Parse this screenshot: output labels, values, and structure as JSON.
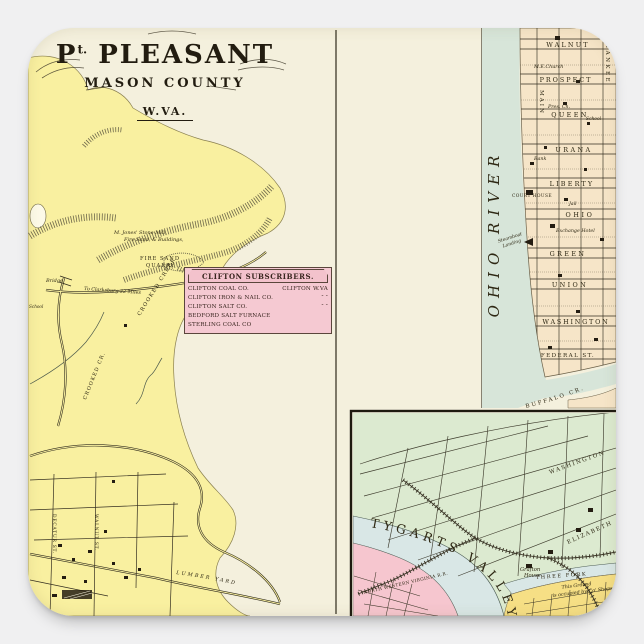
{
  "palette": {
    "page_bg": "#f0f0f1",
    "sticker_bg": "#f4f0dd",
    "ink": "#2f2a1c",
    "yellow_land": "#f9f0a0",
    "table_pink": "#f5c9d2",
    "city_tan": "#f6e5c8",
    "river_green": "#d7e5d9",
    "inset_green": "#dcead0",
    "inset_river": "#d9e7e6",
    "inset_pink": "#f6c6cf",
    "inset_yellow": "#f6df85"
  },
  "title": {
    "prefix": "P",
    "sup": "t.",
    "main": "PLEASANT",
    "county": "MASON COUNTY",
    "state": "W.VA."
  },
  "main_map": {
    "jones_line1": "M. Jones' Stone Mill,",
    "jones_line2": "Fire Sand, & Buildings,",
    "quarry_line1": "FIRE SAND",
    "quarry_line2": "QUARRY",
    "bridge": "Bridge",
    "clarksburg_road": "To Clarksburg 22 Miles",
    "crooked_creek": "CROOKED CREEK",
    "crooked_cr": "CROOKED CR.",
    "school": "School",
    "street_decatur": "DECATUR ST.",
    "street_walnut": "WALNUT ST.",
    "lumber_yard": "LUMBER YARD"
  },
  "subscribers": {
    "title": "CLIFTON SUBSCRIBERS.",
    "rows": [
      {
        "name": "CLIFTON COAL CO.",
        "loc": "CLIFTON W.VA"
      },
      {
        "name": "CLIFTON IRON & NAIL CO.",
        "loc": "″   ″"
      },
      {
        "name": "CLIFTON SALT CO.",
        "loc": "″   ″"
      },
      {
        "name": "BEDFORD SALT FURNACE",
        "loc": ""
      },
      {
        "name": "STERLING COAL CO",
        "loc": ""
      }
    ]
  },
  "river_city": {
    "river": "OHIO RIVER",
    "streets": [
      "WALNUT",
      "PROSPECT",
      "QUEEN",
      "URANA",
      "LIBERTY",
      "OHIO",
      "GREEN",
      "UNION",
      "WASHINGTON",
      "FEDERAL ST."
    ],
    "vertical_streets": [
      "MAIN",
      "YANKEE"
    ],
    "church": "M.E.Church",
    "pres_ch": "Pres. Ch.",
    "school": "School",
    "bank": "Bank",
    "court_house": "COURT HOUSE",
    "jail": "Jail",
    "exchange_hotel": "Exchange Hotel",
    "steamboat_1": "Steamboat",
    "steamboat_2": "Landing",
    "buffalo": "BUFFALO CR."
  },
  "inset": {
    "river": "TYGARTS VALLEY",
    "railroad": "NORTH WESTERN VIRGINIA R.R.",
    "creek": "THREE FORK",
    "street_washington": "WASHINGTON",
    "street_elizabeth": "ELIZABETH",
    "grafton_1": "Grafton",
    "grafton_2": "House",
    "ground_1": "This Ground",
    "ground_2": "is occupied by Co' Shops"
  }
}
